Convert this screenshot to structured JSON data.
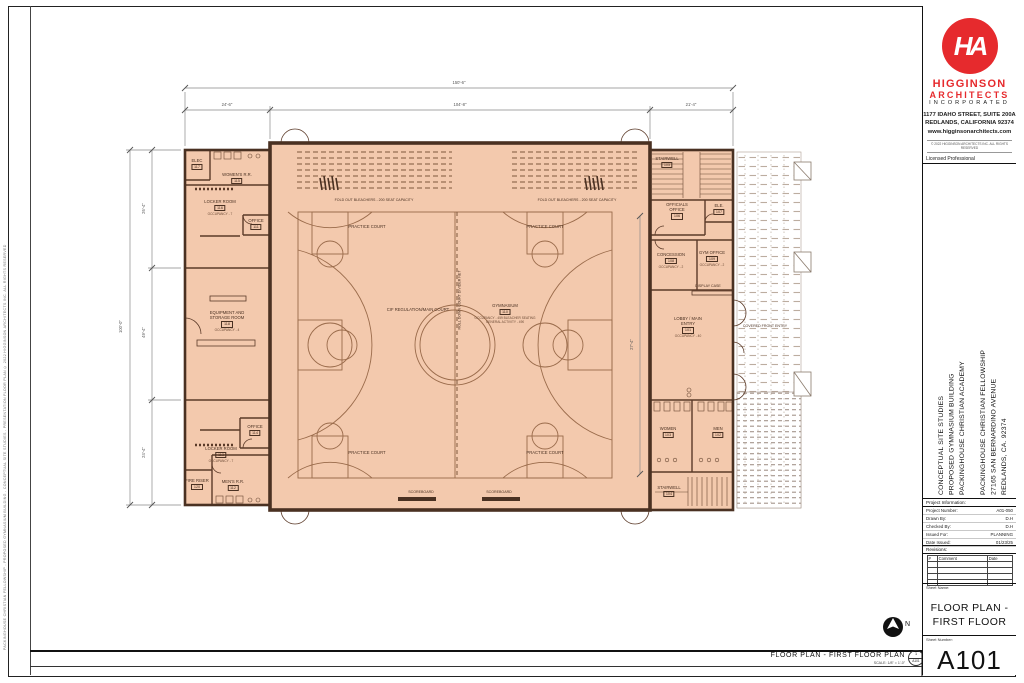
{
  "firm": {
    "monogram": "HA",
    "name_line1": "HIGGINSON",
    "name_line2": "ARCHITECTS",
    "name_line3": "INCORPORATED",
    "address_line1": "1177 IDAHO STREET, SUITE 200A",
    "address_line2": "REDLANDS, CALIFORNIA 92374",
    "website": "www.higginsonarchitects.com",
    "copyright": "© 2022 HIGGINSON ARCHITECTS INC.  ALL RIGHTS RESERVED",
    "licensed": "Licensed Professional"
  },
  "project": {
    "study_line1": "CONCEPTUAL SITE STUDIES",
    "study_line2": "PROPOSED GYMNASIUM BUILDING",
    "study_line3": "PACKINGHOUSE CHRISTIAN ACADEMY",
    "client_line1": "PACKINGHOUSE CHRISTIAN FELLOWSHIP",
    "client_line2": "27165 SAN BERNARDINO AVENUE",
    "client_line3": "REDLANDS, CA. 92374"
  },
  "info": {
    "header": "Project Information:",
    "rows": [
      {
        "label": "Project Number:",
        "value": "A01-050"
      },
      {
        "label": "Drawn By:",
        "value": "D.H"
      },
      {
        "label": "Checked By:",
        "value": "D.H"
      },
      {
        "label": "Issued For:",
        "value": "PLANNING"
      },
      {
        "label": "Date Issued:",
        "value": "01/23/25"
      }
    ]
  },
  "revisions": {
    "header": "Revisions:",
    "col_num": "#",
    "col_comment": "Comment",
    "col_date": "Date"
  },
  "sheet": {
    "name_label": "Sheet Name:",
    "name_line1": "FLOOR PLAN -",
    "name_line2": "FIRST FLOOR",
    "number_label": "Sheet Number:",
    "number": "A101"
  },
  "footer": {
    "title": "FLOOR PLAN - FIRST FLOOR PLAN",
    "scale": "SCALE: 1/8\" = 1'-0\"",
    "detail_num": "1",
    "detail_sheet": "A101",
    "north": "N"
  },
  "margin_note": "PACKINGHOUSE CHRISTIAN FELLOWSHIP - PROPOSED GYMNASIUM BUILDING - CONCEPTUAL SITE STUDIES - PRESENTATION FLOOR PLAN      © 2022 HIGGINSON ARCHITECTS INC.  ALL RIGHTS RESERVED",
  "dims": {
    "top_overall": "150'-6\"",
    "top_seg1": "24'-6\"",
    "top_seg2": "104'-8\"",
    "top_seg3": "21'-4\"",
    "left_overall": "100'-0\"",
    "left_seg1": "26'-4\"",
    "left_seg2": "49'-4\"",
    "left_seg3": "24'-4\"",
    "lobby_width": "27'-4\""
  },
  "plan": {
    "rooms": [
      {
        "name": "ELEC",
        "tag": "117",
        "note": ""
      },
      {
        "name": "WOMEN'S R.R.",
        "tag": "115",
        "note": ""
      },
      {
        "name": "LOCKER ROOM",
        "tag": "116",
        "note": "OCCUPANCY - 7"
      },
      {
        "name": "OFFICE",
        "tag": "111",
        "note": "OCCUPANCY - 1"
      },
      {
        "name": "EQUIPMENT AND STORAGE ROOM",
        "tag": "118",
        "note": "OCCUPANCY - 4"
      },
      {
        "name": "OFFICE",
        "tag": "114",
        "note": "OCCUPANCY - 1"
      },
      {
        "name": "LOCKER ROOM",
        "tag": "113",
        "note": "OCCUPANCY - 7"
      },
      {
        "name": "FIRE RISER",
        "tag": "120",
        "note": ""
      },
      {
        "name": "MEN'S R.R.",
        "tag": "112",
        "note": ""
      },
      {
        "name": "GYMNASIUM",
        "tag": "110",
        "note": ""
      },
      {
        "name": "STAIRWELL",
        "tag": "105",
        "note": ""
      },
      {
        "name": "OFFICIALS OFFICE",
        "tag": "106",
        "note": "OCCUPANCY - 2"
      },
      {
        "name": "ELE.",
        "tag": "107",
        "note": ""
      },
      {
        "name": "CONCESSION",
        "tag": "108",
        "note": "OCCUPANCY - 2"
      },
      {
        "name": "GYM OFFICE",
        "tag": "109",
        "note": "OCCUPANCY - 2"
      },
      {
        "name": "LOBBY / MAIN ENTRY",
        "tag": "101",
        "note": "OCCUPANCY - 40"
      },
      {
        "name": "WOMEN",
        "tag": "103",
        "note": ""
      },
      {
        "name": "MEN",
        "tag": "102",
        "note": ""
      },
      {
        "name": "STAIRWELL",
        "tag": "104",
        "note": ""
      }
    ],
    "labels": {
      "practice": "PRACTICE COURT",
      "main_court": "CIF REGULATION/MAIN COURT",
      "divider": "ROLL DOWN COURT DIVIDER NET",
      "bleachers": "FOLD OUT BLEACHERS - 200 SEAT CAPACITY",
      "scoreboard": "SCOREBOARD",
      "display_case": "DISPLAY CASE",
      "covered_entry": "COVERED FRONT ENTRY",
      "gym_note1": "OCCUPANCY - 459 BLEACHER SEATING",
      "gym_note2": "GENERAL ACTIVITY - 490"
    },
    "colors": {
      "wall": "#4a3122",
      "fill": "#f3c9ad",
      "court_line": "#9a6b4b",
      "logo_red": "#e62a2d"
    }
  }
}
